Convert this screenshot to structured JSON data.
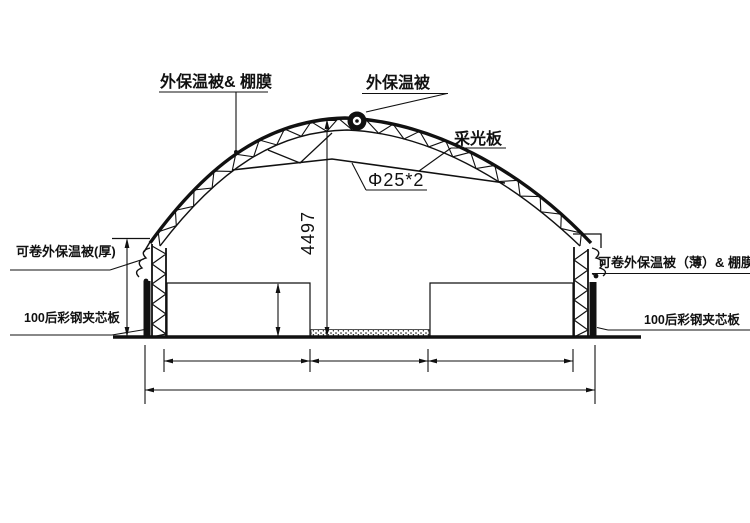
{
  "canvas": {
    "background": "#ffffff",
    "line_color": "#111111"
  },
  "labels": {
    "roof_quilt_film": "外保温被& 棚膜",
    "roof_quilt": "外保温被",
    "daylight_panel": "采光板",
    "pipe_spec": "Φ25*2",
    "left_quilt_thick": "可卷外保温被(厚)",
    "left_panel": "100后彩钢夹芯板",
    "right_quilt_thin_film": "可卷外保温被（薄）& 棚膜",
    "right_panel": "100后彩钢夹芯板"
  },
  "dimensions": {
    "ridge_height": "4497"
  }
}
